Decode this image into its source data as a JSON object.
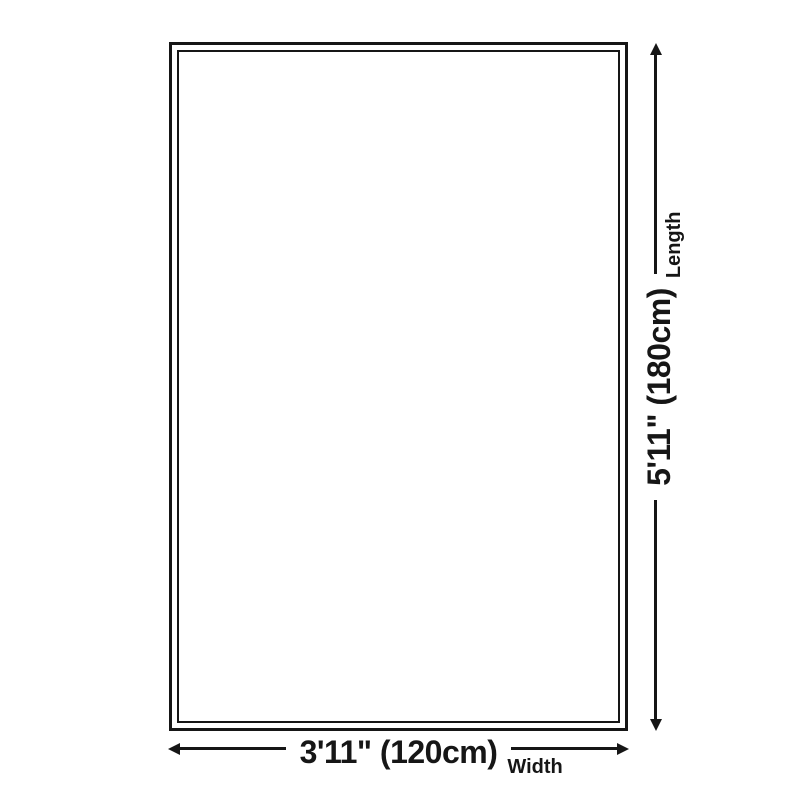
{
  "colors": {
    "line": "#161616",
    "text": "#161616",
    "background": "#ffffff"
  },
  "icons": {
    "width_start": "arrow-left-icon",
    "width_end": "arrow-right-icon",
    "length_start": "arrow-down-icon",
    "length_end": "arrow-up-icon"
  },
  "dimensions": {
    "length": {
      "value": "5'11\" (180cm)",
      "label": "Length"
    },
    "width": {
      "value": "3'11\" (120cm)",
      "label": "Width"
    }
  }
}
